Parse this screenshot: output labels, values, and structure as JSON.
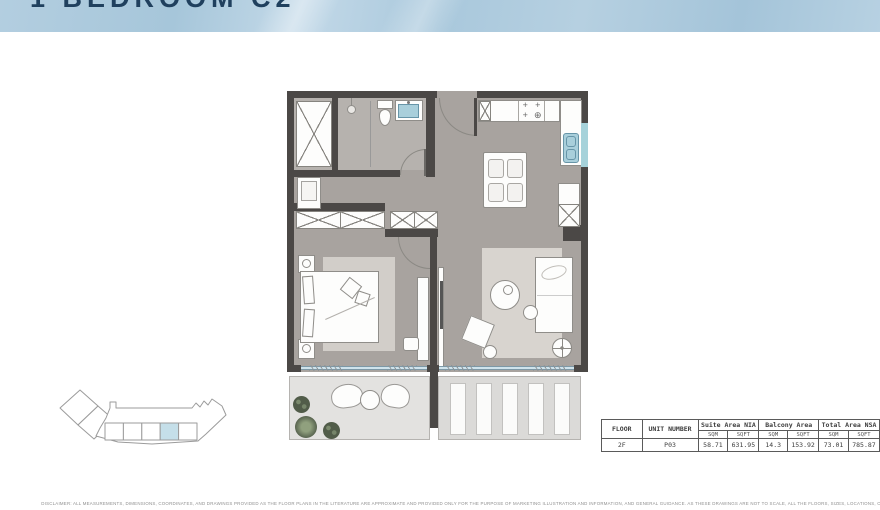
{
  "page": {
    "title": "1 BEDROOM C2",
    "disclaimer": "DISCLAIMER: ALL MEASUREMENTS, DIMENSIONS, COORDINATES, AND DRAWINGS PROVIDED AS THE FLOOR PLANS IN THE LITERATURE ARE APPROXIMATE AND PROVIDED ONLY FOR THE PURPOSE OF MARKETING ILLUSTRATION AND INFORMATION, AND GENERAL GUIDANCE. AS THESE DRAWINGS ARE NOT TO SCALE, ALL THE FLOORS, SIZES, LOCATIONS, ORIENTATIONS, DIMENSIONS, PICTURES, FITTINGS, FINISHES AND SPECIFICATIONS DISCLAIMED."
  },
  "key_plan": {
    "units_count": 5,
    "highlighted_unit_index": 4
  },
  "area_table": {
    "headers": {
      "floor": "FLOOR",
      "unit_number": "UNIT NUMBER",
      "suite": "Suite Area NIA",
      "balcony": "Balcony Area",
      "total": "Total Area NSA",
      "sqm": "SQM",
      "sqft": "SQFT"
    },
    "row": {
      "floor": "2F",
      "unit_number": "P03",
      "suite_sqm": "58.71",
      "suite_sqft": "631.95",
      "balcony_sqm": "14.3",
      "balcony_sqft": "153.92",
      "total_sqm": "73.01",
      "total_sqft": "785.87"
    }
  },
  "colors": {
    "header_blue": "#aecbdd",
    "title_navy": "#20405e",
    "wall": "#4b4846",
    "floor": "#a8a39f",
    "bathroom_floor": "#b6b2ae",
    "fixture_blue": "#a9cfdb",
    "keyplan_highlight": "#c5dfe9"
  }
}
